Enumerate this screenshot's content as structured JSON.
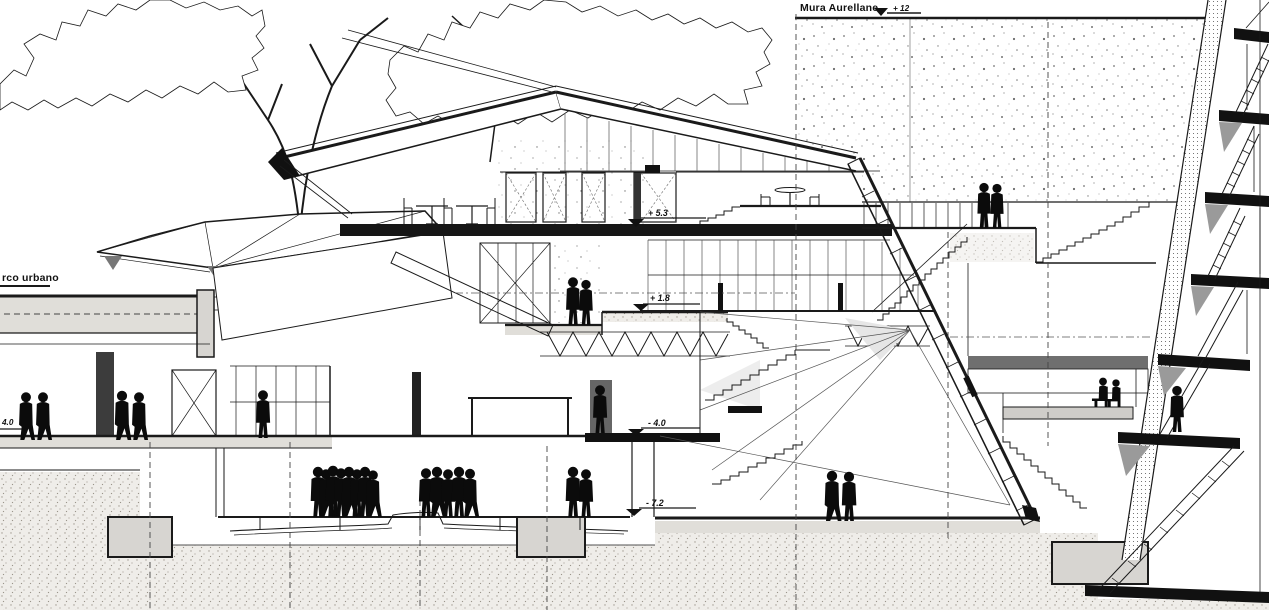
{
  "labels": {
    "wall": "Mura Aurellane",
    "park": "rco urbano"
  },
  "markers": {
    "wall_top": "+ 12",
    "level_plus53": "+ 5.3",
    "level_plus18": "+ 1.8",
    "level_minus40": "- 4.0",
    "level_minus72": "- 7.2",
    "left_level": "4.0"
  },
  "colors": {
    "ink": "#1a1a1a",
    "paper": "#ffffff",
    "silhouette": "#0b0b0b",
    "slab_grey": "#e0ded9"
  }
}
